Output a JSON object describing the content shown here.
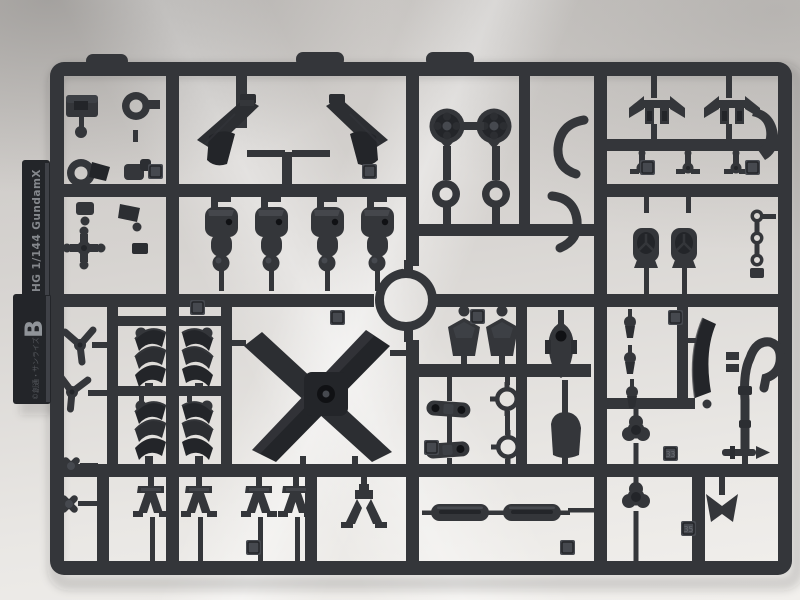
{
  "scene": {
    "tag": {
      "series_text": "HG 1/144 GundamX",
      "runner_letter": "B",
      "copyright_text": "©創通・サンライズ"
    },
    "part_number_labels": [
      "33",
      "35"
    ],
    "colors": {
      "plastic": "#34363a",
      "plastic_dark": "#232529",
      "plastic_deep": "#101114",
      "plastic_light": "#46494f",
      "backdrop": "#d6d3d0",
      "backdrop_bright": "#f2f0ed"
    }
  }
}
